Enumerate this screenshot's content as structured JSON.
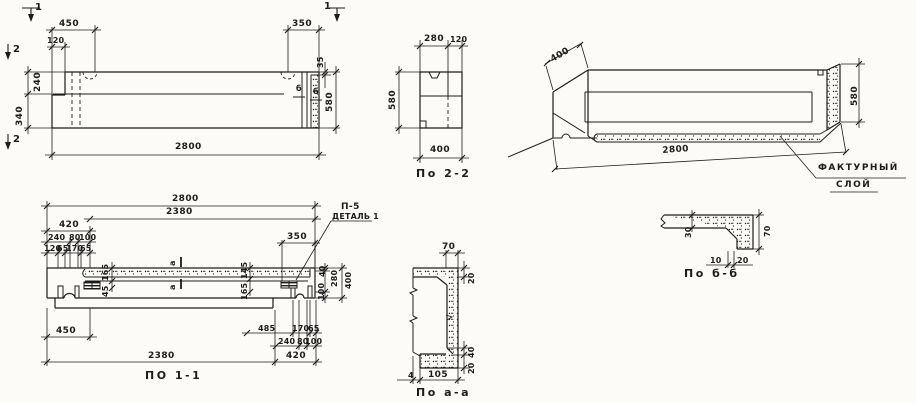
{
  "colors": {
    "ink": "#1c1c1c",
    "paper": "#fcfbf8"
  },
  "elev": {
    "m1l": "1",
    "m1r": "1",
    "m2t": "2",
    "m2b": "2",
    "d450": "450",
    "d120": "120",
    "d350": "350",
    "d35": "35",
    "d240": "240",
    "d340": "340",
    "d580": "580",
    "d2800": "2800",
    "b1": "б",
    "b2": "б"
  },
  "s22": {
    "d280": "280",
    "d120": "120",
    "d580": "580",
    "d400": "400",
    "label": "По 2-2"
  },
  "axon": {
    "d400": "400",
    "d580": "580",
    "d2800": "2800",
    "callout1": "ФАКТУРНЫЙ",
    "callout2": "СЛОЙ"
  },
  "plan": {
    "d2800": "2800",
    "d2380_top": "2380",
    "d420_top": "420",
    "d240_top": "240",
    "d80_top": "80",
    "d100_top": "100",
    "d120": "120",
    "d65_1": "65",
    "d170_top": "170",
    "d65_2": "65",
    "d165_left": "165",
    "d45_left": "45",
    "d145_right": "145",
    "d165_right": "165",
    "d350": "350",
    "p5": "П-5",
    "detail1": "ДЕТАЛЬ 1",
    "a_top": "а",
    "a_bottom": "а",
    "d40_right": "40",
    "d280_right": "280",
    "d100_right": "100",
    "d400_right": "400",
    "d450": "450",
    "d485": "485",
    "d170_bottom": "170",
    "d65_3": "65",
    "d240_bottom": "240",
    "d80_bottom": "80",
    "d100_bottom": "100",
    "d2380_bottom": "2380",
    "d420_bottom": "420",
    "label": "ПО 1-1"
  },
  "saa": {
    "d70": "70",
    "d20_top": "20",
    "d40": "40",
    "d20_bottom": "20",
    "d4": "4",
    "d105": "105",
    "label": "По а-а"
  },
  "sbb": {
    "d30": "30",
    "d70": "70",
    "d10": "10",
    "d20": "20",
    "label": "По б-б"
  }
}
